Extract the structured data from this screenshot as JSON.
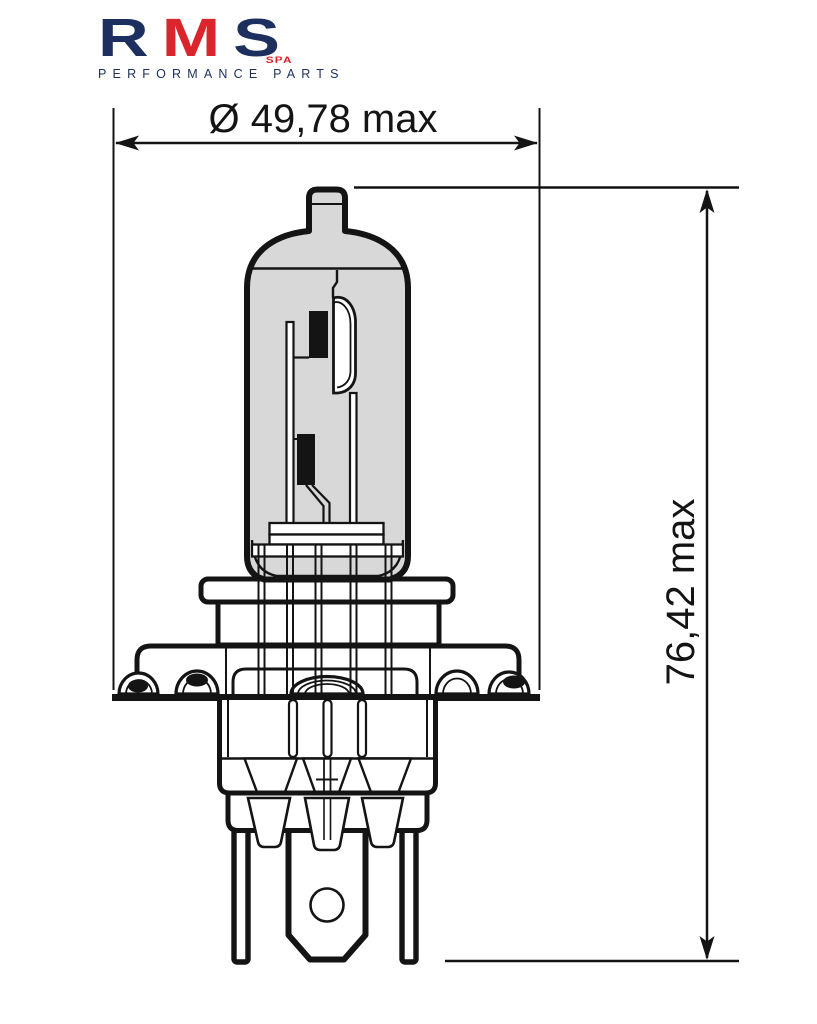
{
  "page": {
    "background": "#ffffff"
  },
  "logo": {
    "letters": {
      "r": "R",
      "m": "M",
      "s": "S"
    },
    "sub": "SPA",
    "tagline": "PERFORMANCE PARTS",
    "colors": {
      "navy": "#1c2f5e",
      "red": "#d9252b"
    }
  },
  "drawing": {
    "subject": "halogen-headlight-bulb-side-elevation",
    "line_color": "#141414",
    "glass_fill": "#d8d8d8",
    "dimensions": {
      "diameter_label": "Ø 49,78 max",
      "height_label": "76,42 max"
    }
  }
}
